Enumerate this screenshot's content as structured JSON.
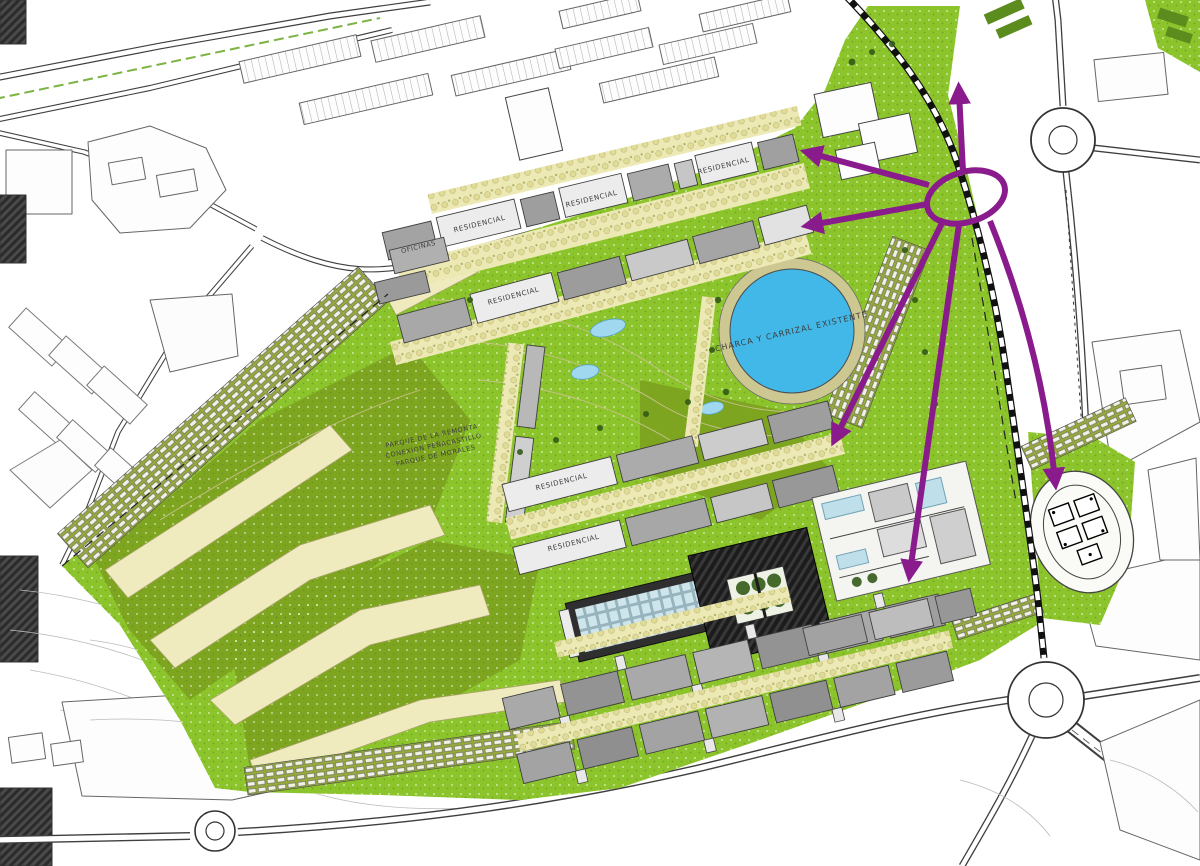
{
  "map": {
    "labels": {
      "pond": "CHARCA Y CARRIZAL EXISTENTE",
      "offices": "OFICINAS",
      "residential": "RESIDENCIAL",
      "park_line1": "PARQUE DE LA REMONTA",
      "park_line2": "CONEXION PEÑACASTILLO",
      "park_line3": "PARQUE DE MORALES"
    },
    "colors": {
      "park_green": "#8CC42C",
      "olive_green": "#7EA520",
      "path_cream": "#EFEBBE",
      "pond_blue": "#41B8E8",
      "arrow_purple": "#8A1B8D",
      "building_gray": "#A8A8A8",
      "dark_building": "#1C1C1C",
      "glass_blue": "#CFE5EC",
      "allotment_green": "#96A93E",
      "speck_dark": "#5E7D14",
      "label_gray": "#3D3D3D",
      "road_dark": "#3F3F3F",
      "contour_tan": "#C8C28E"
    }
  }
}
